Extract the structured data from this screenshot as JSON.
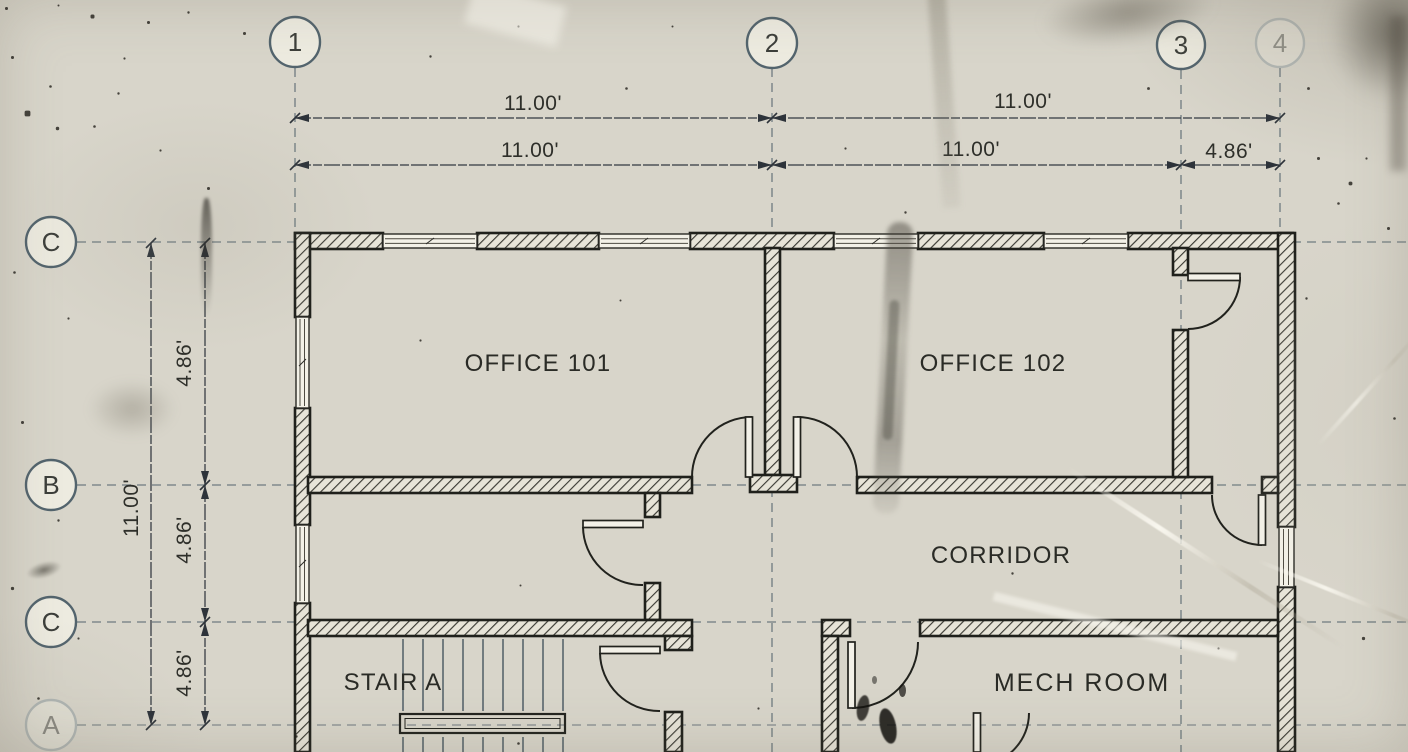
{
  "sheet": {
    "paper_color": "#ebe9de",
    "ink_color": "#23241f",
    "grid_color": "#51626b",
    "dim_color": "#3a4147"
  },
  "grid": {
    "columns": [
      {
        "label": "1"
      },
      {
        "label": "2"
      },
      {
        "label": "3"
      },
      {
        "label": "4"
      }
    ],
    "rows": [
      {
        "label": "C"
      },
      {
        "label": "B"
      },
      {
        "label": "C"
      },
      {
        "label": "A"
      }
    ]
  },
  "dimensions": {
    "top_row_1": [
      {
        "value": "11.00'"
      },
      {
        "value": "11.00'"
      }
    ],
    "top_row_2": [
      {
        "value": "11.00'"
      },
      {
        "value": "11.00'"
      },
      {
        "value": "4.86'"
      }
    ],
    "left_overall": {
      "value": "11.00'"
    },
    "left_segments": [
      {
        "value": "4.86'"
      },
      {
        "value": "4.86'"
      },
      {
        "value": "4.86'"
      }
    ]
  },
  "rooms": [
    {
      "name": "OFFICE 101"
    },
    {
      "name": "OFFICE 102"
    },
    {
      "name": "CORRIDOR"
    },
    {
      "name": "STAIR A"
    },
    {
      "name": "MECH ROOM"
    }
  ]
}
